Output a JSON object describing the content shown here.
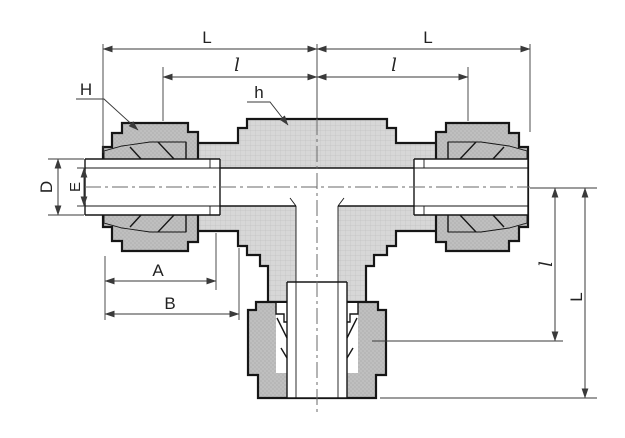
{
  "drawing": {
    "kind": "tube-fitting-union-tee-section-drawing",
    "labels": {
      "top_left_L": "L",
      "top_right_L": "L",
      "top_left_l": "l",
      "top_right_l": "l",
      "nut_leader_H": "H",
      "body_leader_h": "h",
      "outer_diameter_D": "D",
      "bore_E": "E",
      "length_A": "A",
      "length_B": "B",
      "side_l": "l",
      "side_L": "L"
    },
    "colors": {
      "background": "#ffffff",
      "body_fill": "#d7d7d7",
      "nut_fill": "#bfbfbf",
      "body_grid": "#c2c2c2",
      "nut_dot": "#9a9a9a",
      "outline": "#161616",
      "dimension": "#3a3a3a",
      "centerline": "#6a6a6a",
      "text": "#222222"
    }
  }
}
